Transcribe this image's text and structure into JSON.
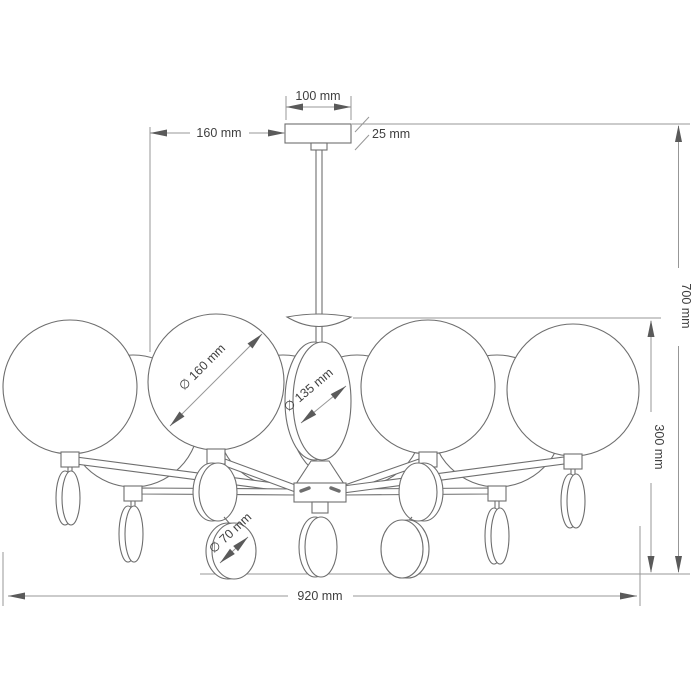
{
  "drawing": {
    "background": "#ffffff",
    "line_color": "#6e6e6e",
    "dim_line_color": "#979797",
    "text_color": "#3f3f3f",
    "dimensions": {
      "canopy_width": "100 mm",
      "hang_offset": "160 mm",
      "canopy_height": "25 mm",
      "total_height": "700 mm",
      "fixture_height": "300 mm",
      "total_width": "920 mm",
      "globe_diameter": "∅ 160 mm",
      "center_disc_diameter": "∅ 135 mm",
      "ornament_disc_diameter": "∅ 70 mm"
    }
  }
}
